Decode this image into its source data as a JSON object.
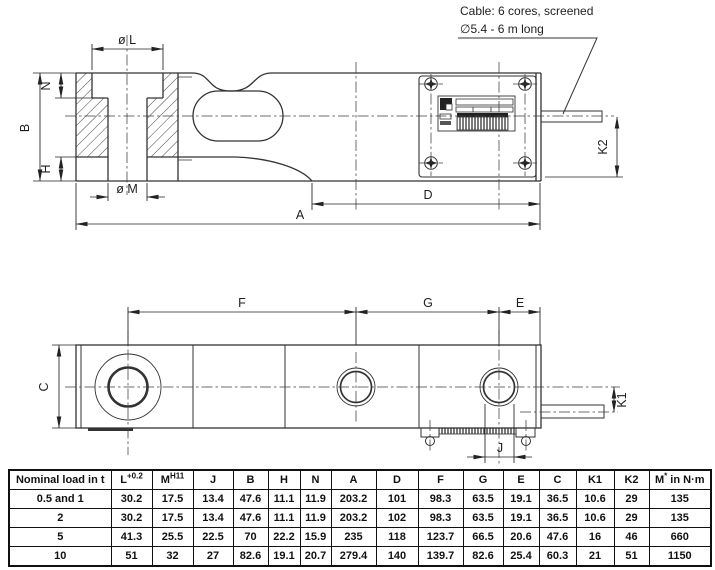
{
  "drawing": {
    "cable_note": {
      "line1": "Cable: 6 cores, screened",
      "line2": "∅5.4 - 6 m long"
    },
    "side_view": {
      "dim_oL": "ø L",
      "dim_N": "N",
      "dim_B": "B",
      "dim_H": "H",
      "dim_oM": "ø M",
      "dim_A": "A",
      "dim_D": "D",
      "dim_K2": "K2"
    },
    "plan_view": {
      "dim_F": "F",
      "dim_G": "G",
      "dim_E": "E",
      "dim_C": "C",
      "dim_K1": "K1",
      "dim_J": "J"
    }
  },
  "table": {
    "col_headers": [
      {
        "base": "Nominal load in t",
        "sup": "",
        "suffix": ""
      },
      {
        "base": "L",
        "sup": "+0.2",
        "suffix": ""
      },
      {
        "base": "M",
        "sup": "H11",
        "suffix": ""
      },
      {
        "base": "J",
        "sup": "",
        "suffix": ""
      },
      {
        "base": "B",
        "sup": "",
        "suffix": ""
      },
      {
        "base": "H",
        "sup": "",
        "suffix": ""
      },
      {
        "base": "N",
        "sup": "",
        "suffix": ""
      },
      {
        "base": "A",
        "sup": "",
        "suffix": ""
      },
      {
        "base": "D",
        "sup": "",
        "suffix": ""
      },
      {
        "base": "F",
        "sup": "",
        "suffix": ""
      },
      {
        "base": "G",
        "sup": "",
        "suffix": ""
      },
      {
        "base": "E",
        "sup": "",
        "suffix": ""
      },
      {
        "base": "C",
        "sup": "",
        "suffix": ""
      },
      {
        "base": "K1",
        "sup": "",
        "suffix": ""
      },
      {
        "base": "K2",
        "sup": "",
        "suffix": ""
      },
      {
        "base": "M",
        "sup": "*",
        "suffix": " in N·m"
      }
    ],
    "rows": [
      {
        "load": "0.5 and 1",
        "values": [
          "30.2",
          "17.5",
          "13.4",
          "47.6",
          "11.1",
          "11.9",
          "203.2",
          "101",
          "98.3",
          "63.5",
          "19.1",
          "36.5",
          "10.6",
          "29",
          "135"
        ]
      },
      {
        "load": "2",
        "values": [
          "30.2",
          "17.5",
          "13.4",
          "47.6",
          "11.1",
          "11.9",
          "203.2",
          "102",
          "98.3",
          "63.5",
          "19.1",
          "36.5",
          "10.6",
          "29",
          "135"
        ]
      },
      {
        "load": "5",
        "values": [
          "41.3",
          "25.5",
          "22.5",
          "70",
          "22.2",
          "15.9",
          "235",
          "118",
          "123.7",
          "66.5",
          "20.6",
          "47.6",
          "16",
          "46",
          "660"
        ]
      },
      {
        "load": "10",
        "values": [
          "51",
          "32",
          "27",
          "82.6",
          "19.1",
          "20.7",
          "279.4",
          "140",
          "139.7",
          "82.6",
          "25.4",
          "60.3",
          "21",
          "51",
          "1150"
        ]
      }
    ]
  }
}
